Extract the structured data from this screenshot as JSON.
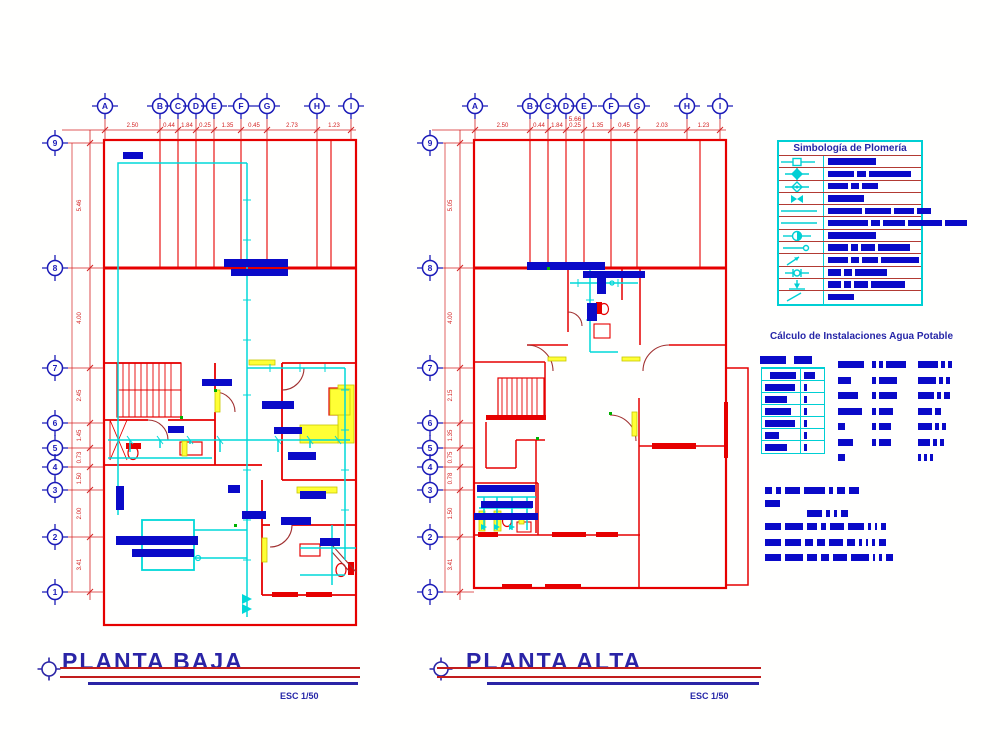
{
  "colors": {
    "wall_red": "#e60000",
    "door_dark_red": "#a03030",
    "pipe_cyan": "#00d8d8",
    "legend_cyan": "#00cfd4",
    "label_blue": "#0a0ac8",
    "title_navy": "#2a24a6",
    "dimension_red": "#d42222",
    "fixture_yellow": "#ffff35"
  },
  "plans": [
    {
      "name": "planta-baja",
      "title": "PLANTA BAJA",
      "scale_label": "ESC 1/50",
      "grid_columns": [
        "A",
        "B",
        "C",
        "D",
        "E",
        "F",
        "G",
        "H",
        "I"
      ],
      "grid_rows": [
        "9",
        "8",
        "7",
        "6",
        "5",
        "4",
        "3",
        "2",
        "1"
      ],
      "top_dimensions": [
        "2.50",
        "0.44",
        "1.84",
        "0.25",
        "1.35",
        "0.45",
        "2.73",
        "1.23"
      ],
      "side_dimensions": [
        "5.46",
        "4.00",
        "2.45",
        "1.45",
        "0.73",
        "1.50",
        "2.00",
        "3.41"
      ],
      "overall_dimension": ""
    },
    {
      "name": "planta-alta",
      "title": "PLANTA ALTA",
      "scale_label": "ESC 1/50",
      "grid_columns": [
        "A",
        "B",
        "C",
        "D",
        "E",
        "F",
        "G",
        "H",
        "I"
      ],
      "grid_rows": [
        "9",
        "8",
        "7",
        "6",
        "5",
        "4",
        "3",
        "2",
        "1"
      ],
      "top_dimensions": [
        "2.50",
        "0.44",
        "1.84",
        "0.25",
        "1.35",
        "0.45",
        "2.03",
        "1.23"
      ],
      "side_dimensions": [
        "5.05",
        "4.00",
        "2.15",
        "1.35",
        "0.75",
        "0.78",
        "1.50",
        "3.41"
      ],
      "overall_dimension": "5.66"
    }
  ],
  "legend": {
    "title": "Simbología de Plomería",
    "rows": [
      {
        "symbol": "valve-square-inline",
        "blocks": [
          48
        ]
      },
      {
        "symbol": "valve-solid-diamond",
        "blocks": [
          26,
          9,
          42
        ]
      },
      {
        "symbol": "valve-open-diamond",
        "blocks": [
          20,
          8,
          16
        ]
      },
      {
        "symbol": "gate-valve",
        "blocks": [
          36
        ]
      },
      {
        "symbol": "cold-water-line",
        "blocks": [
          34,
          26,
          20,
          14
        ]
      },
      {
        "symbol": "hot-water-line",
        "blocks": [
          40,
          9,
          22,
          34,
          22
        ]
      },
      {
        "symbol": "water-meter",
        "blocks": [
          48
        ]
      },
      {
        "symbol": "pipe-with-plug",
        "blocks": [
          20,
          7,
          14,
          32
        ]
      },
      {
        "symbol": "riser-up-arrow",
        "blocks": [
          20,
          8,
          16,
          38
        ]
      },
      {
        "symbol": "pipe-union",
        "blocks": [
          13,
          8,
          32
        ]
      },
      {
        "symbol": "riser-down-arrow",
        "blocks": [
          13,
          7,
          14,
          34
        ]
      },
      {
        "symbol": "slope-indicator",
        "blocks": [
          26
        ]
      }
    ]
  },
  "calc_table": {
    "title": "Cálculo de Instalaciones Agua Potable",
    "header_blocks": [
      26,
      18
    ],
    "rows": [
      {
        "left": 26,
        "right": 11
      },
      {
        "left": 30,
        "right": 3
      },
      {
        "left": 22,
        "right": 3
      },
      {
        "left": 26,
        "right": 3
      },
      {
        "left": 30,
        "right": 3
      },
      {
        "left": 14,
        "right": 3
      },
      {
        "left": 22,
        "right": 3
      }
    ],
    "detail_rows": [
      {
        "g1": [
          26
        ],
        "g2": [
          4,
          4,
          20
        ],
        "g3": [
          20,
          4,
          4
        ]
      },
      {
        "g1": [
          13
        ],
        "g2": [
          4,
          18
        ],
        "g3": [
          18,
          4,
          4
        ]
      },
      {
        "g1": [
          20
        ],
        "g2": [
          4,
          18
        ],
        "g3": [
          16,
          4,
          6
        ]
      },
      {
        "g1": [
          24
        ],
        "g2": [
          4,
          14
        ],
        "g3": [
          14,
          6
        ]
      },
      {
        "g1": [
          7
        ],
        "g2": [
          4,
          12
        ],
        "g3": [
          14,
          4,
          4
        ]
      },
      {
        "g1": [
          15
        ],
        "g2": [
          4,
          12
        ],
        "g3": [
          12,
          4,
          4
        ]
      },
      {
        "g1": [
          7
        ],
        "g2": [],
        "g3": [
          3,
          3,
          3
        ]
      }
    ],
    "notes": [
      {
        "indent": 0,
        "blocks": [
          7,
          5,
          15,
          21,
          4,
          8,
          10
        ]
      },
      {
        "indent": 0,
        "blocks": [
          15
        ]
      },
      {
        "indent": 42,
        "blocks": [
          15,
          4,
          3,
          7
        ]
      },
      {
        "indent": 0,
        "blocks": [
          16,
          18,
          10,
          5,
          14,
          16,
          3,
          2,
          5
        ]
      },
      {
        "indent": 0,
        "blocks": [
          16,
          16,
          8,
          8,
          14,
          8,
          3,
          2,
          3,
          7
        ]
      },
      {
        "indent": 0,
        "blocks": [
          16,
          18,
          10,
          8,
          14,
          18,
          2,
          3,
          7
        ]
      }
    ]
  }
}
